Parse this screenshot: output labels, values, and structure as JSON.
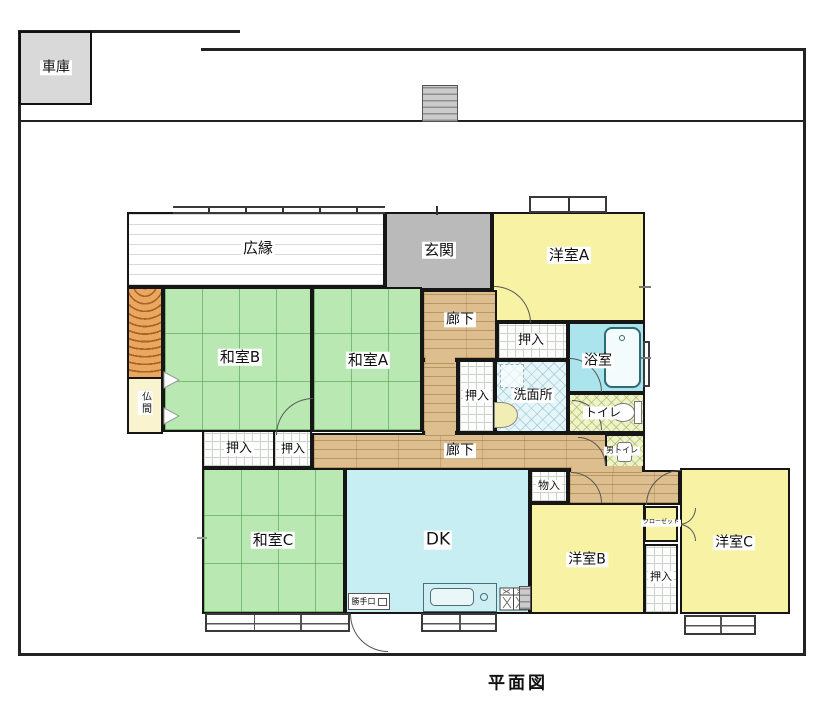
{
  "title": "平面図",
  "garage": {
    "label": "車庫"
  },
  "rooms": {
    "hiroen": {
      "label": "広縁"
    },
    "genkan": {
      "label": "玄関"
    },
    "yoshitsu_a": {
      "label": "洋室A"
    },
    "washitsu_b": {
      "label": "和室B"
    },
    "washitsu_a": {
      "label": "和室A"
    },
    "washitsu_c": {
      "label": "和室C"
    },
    "yoshitsu_b": {
      "label": "洋室B"
    },
    "yoshitsu_c": {
      "label": "洋室C"
    },
    "dk": {
      "label": "DK"
    },
    "rouka_upper": {
      "label": "廊下"
    },
    "rouka_lower": {
      "label": "廊下"
    },
    "butsuma": {
      "label": "仏間"
    },
    "yokushitsu": {
      "label": "浴室"
    },
    "senmenjo": {
      "label": "洗面所"
    },
    "toilet": {
      "label": "トイレ"
    },
    "mens_toilet": {
      "label": "男トイレ"
    },
    "monoire": {
      "label": "物入"
    },
    "closet": {
      "label": "クローゼット"
    },
    "katteguchi": {
      "label": "勝手口"
    },
    "oshiire_1": {
      "label": "押入"
    },
    "oshiire_2": {
      "label": "押入"
    },
    "oshiire_3": {
      "label": "押入"
    },
    "oshiire_4": {
      "label": "押入"
    },
    "oshiire_5": {
      "label": "押入"
    }
  },
  "colors": {
    "tatami_green": "#bae8b3",
    "western_yellow": "#f8f3a4",
    "entrance_gray": "#bababa",
    "corridor_wood": "#ddbe8e",
    "bath_cyan": "#abe4ec",
    "dk_blue": "#c7eff3",
    "butsuma_cream": "#faf3cf",
    "tokonoma_orange": "#eaa75f",
    "toilet_green": "#eff3c9"
  }
}
